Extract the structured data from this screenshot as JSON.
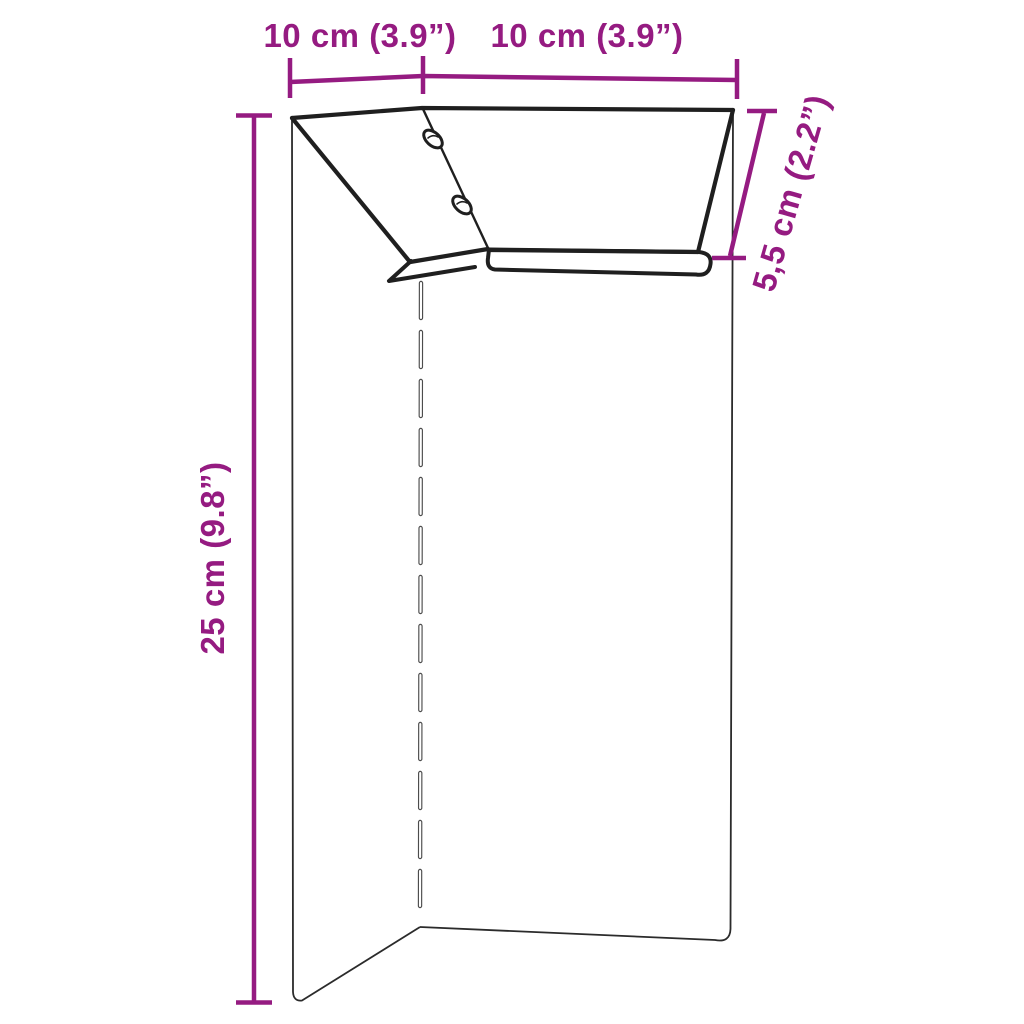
{
  "diagram": {
    "type": "product-dimension-drawing",
    "background_color": "#ffffff",
    "accent_color": "#951b81",
    "outline_color": "#1f1f1f",
    "object": {
      "description": "L-shaped corner panel with angled top plate, folded bottom lips and two oval screw slots",
      "screw_slot_count": 2
    },
    "labels": {
      "top_left_width": "10 cm (3.9”)",
      "top_right_width": "10 cm (3.9”)",
      "height": "25 cm (9.8”)",
      "depth": "5,5 cm (2.2”)"
    }
  }
}
